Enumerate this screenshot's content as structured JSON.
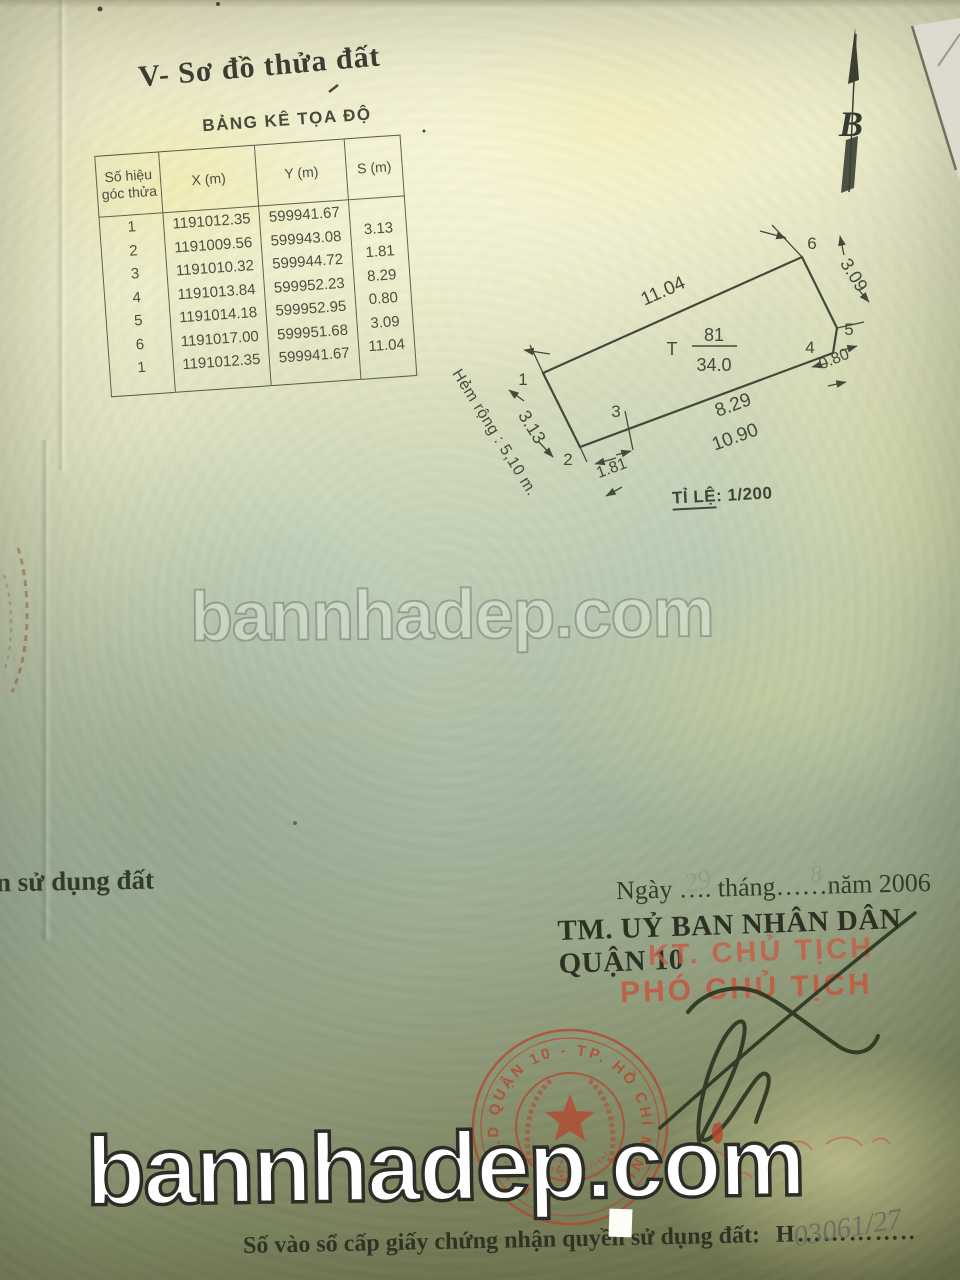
{
  "page": {
    "section_title": "V- Sơ đồ thửa đất",
    "north_letter": "B",
    "left_edge_fragment": "n sử dụng đất",
    "watermark_text": "bannhadep.com"
  },
  "table": {
    "title": "BẢNG KÊ TỌA ĐỘ",
    "col_point": "Số hiệu\ngóc thửa",
    "col_x": "X (m)",
    "col_y": "Y (m)",
    "col_s": "S (m)",
    "rows": [
      {
        "p": "1",
        "x": "1191012.35",
        "y": "599941.67",
        "s": ""
      },
      {
        "p": "2",
        "x": "1191009.56",
        "y": "599943.08",
        "s": "3.13"
      },
      {
        "p": "3",
        "x": "1191010.32",
        "y": "599944.72",
        "s": "1.81"
      },
      {
        "p": "4",
        "x": "1191013.84",
        "y": "599952.23",
        "s": "8.29"
      },
      {
        "p": "5",
        "x": "1191014.18",
        "y": "599952.95",
        "s": "0.80"
      },
      {
        "p": "6",
        "x": "1191017.00",
        "y": "599951.68",
        "s": "3.09"
      },
      {
        "p": "1",
        "x": "1191012.35",
        "y": "599941.67",
        "s": "11.04"
      }
    ]
  },
  "diagram": {
    "dim_top": "11.04",
    "dim_left": "3.13",
    "dim_bottom_1": "1.81",
    "dim_bottom_2": "8.29",
    "dim_bottom_total": "10.90",
    "dim_right_small": "0.80",
    "dim_right": "3.09",
    "p1": "1",
    "p2": "2",
    "p3": "3",
    "p4": "4",
    "p5": "5",
    "p6": "6",
    "lot_prefix": "T",
    "lot_number": "81",
    "lot_area": "34.0",
    "alley_label": "Hẻm rộng : 5,10 m.",
    "scale_label": "TỈ LỆ",
    "scale_value": ":  1/200"
  },
  "footer": {
    "date_line": "Ngày  ….  tháng……năm 2006",
    "hand_day": "29",
    "hand_month": "8",
    "authority_line": "TM. UỶ BAN NHÂN DÂN QUẬN 10",
    "stamp_title_1": "KT. CHỦ TỊCH",
    "stamp_title_2": "PHÓ CHỦ TỊCH",
    "seal_rim_text": "U.B.N.D QUẬN 10 - TP. HỒ CHÍ MINH",
    "register_line": "Số vào sổ cấp giấy chứng nhận quyền sử dụng đất:",
    "register_value": "H…………..",
    "hand_number": "03061/27"
  },
  "colors": {
    "paper_top": "#eeeac8",
    "paper_mid": "#b8c5ac",
    "paper_bottom": "#6d7048",
    "ink": "#454a3c",
    "serif_ink": "#2c3123",
    "stamp_red": "#b5452e",
    "watermark_white": "#fefefe"
  }
}
